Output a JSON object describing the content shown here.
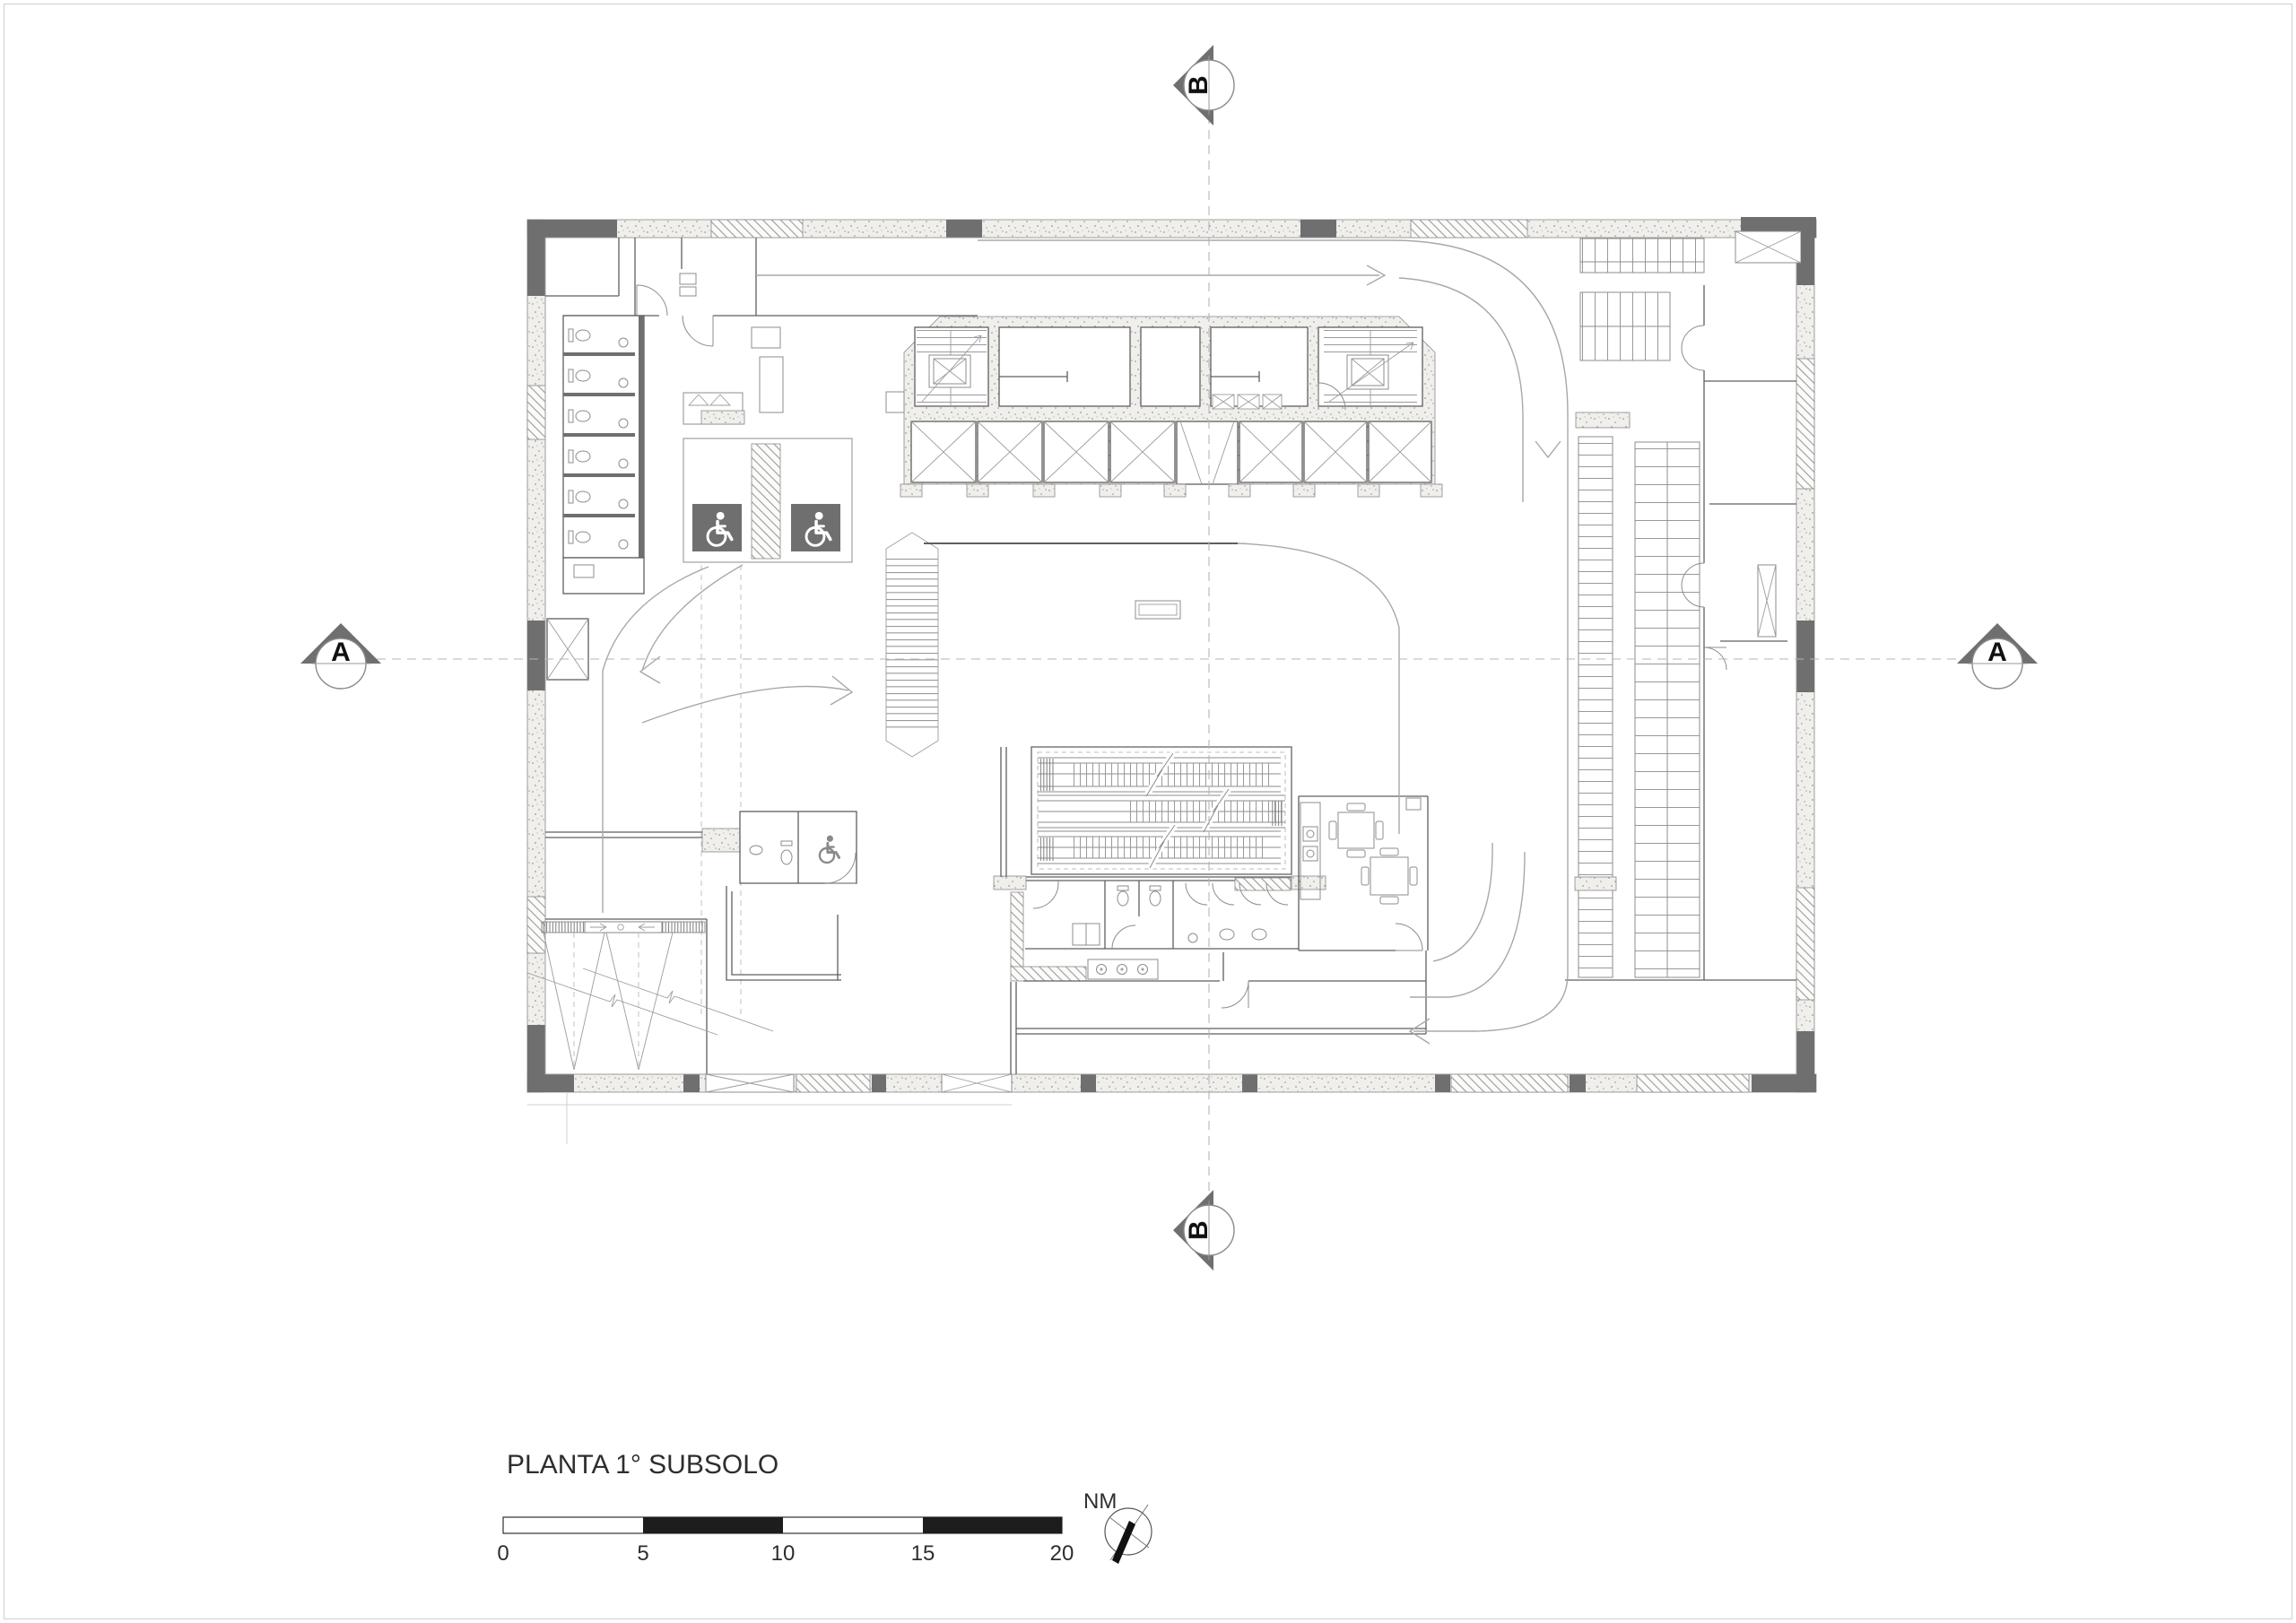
{
  "legend": {
    "title": "PLANTA 1° SUBSOLO",
    "scale_labels": [
      "0",
      "5",
      "10",
      "15",
      "20"
    ],
    "north_label": "NM"
  },
  "section_markers": {
    "top": "B",
    "bottom": "B",
    "left": "A",
    "right": "A"
  },
  "icons": {
    "accessible_parking": "wheelchair-icon",
    "north": "north-arrow-icon",
    "section": "section-cut-marker"
  },
  "colors": {
    "wall_dark": "#6f6f6f",
    "line": "#5f5f5f",
    "text": "#2e2e2e",
    "paper": "#ffffff"
  }
}
